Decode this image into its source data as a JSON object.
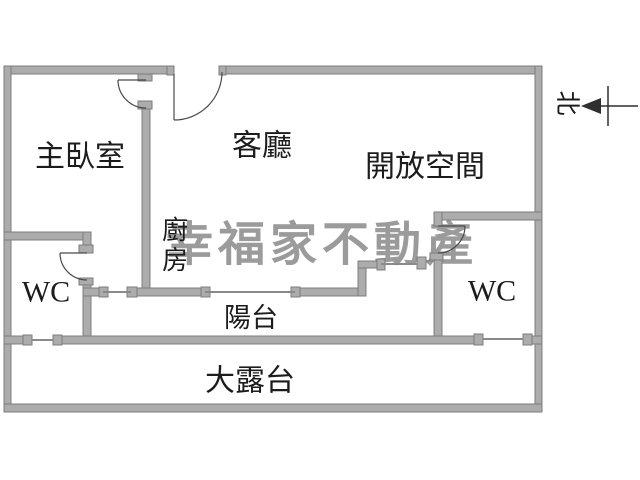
{
  "title": "apartment-floor-plan",
  "colors": {
    "background": "#ffffff",
    "wall_fill": "#acacac",
    "wall_edge": "#7d7d7d",
    "window_line": "#8a8a8a",
    "line": "#4a4a4a",
    "line_dark": "#2f2f2f",
    "text": "#1c1c1c",
    "watermark": "#9b9b9b"
  },
  "rooms": [
    {
      "id": "master-bedroom",
      "label": "主臥室"
    },
    {
      "id": "living-room",
      "label": "客廳"
    },
    {
      "id": "open-space",
      "label": "開放空間"
    },
    {
      "id": "kitchen",
      "label": "廚房"
    },
    {
      "id": "wc-left",
      "label": "WC"
    },
    {
      "id": "wc-right",
      "label": "WC"
    },
    {
      "id": "balcony",
      "label": "陽台"
    },
    {
      "id": "terrace",
      "label": "大露台"
    }
  ],
  "compass": {
    "label": "北"
  },
  "watermark": {
    "text": "幸福家不動產"
  }
}
